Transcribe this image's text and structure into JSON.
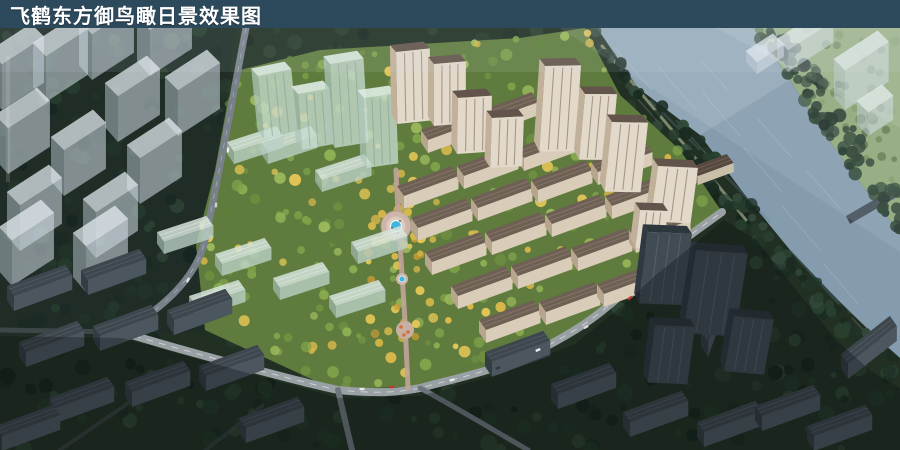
{
  "header": {
    "title": "飞鹤东方御鸟瞰日景效果图"
  },
  "palette": {
    "header_bg": "#2d4a5d",
    "header_text": "#ffffff",
    "water": "#849cae",
    "forest_base": "#213023",
    "meadow": "#8fa878",
    "site_ground": "#5f7c3e",
    "gold_foliage": "#d9b84a",
    "tan_wall": "#d9ccb8",
    "tan_roof": "#6e6055",
    "glass_green": "#c7dbd0",
    "ghost_white": "#dde5ec",
    "dark_building": "#46505a",
    "road_light": "#9aa1a5",
    "plaza_paving": "#cdb6a9",
    "pool_cyan": "#3fb6dc"
  }
}
